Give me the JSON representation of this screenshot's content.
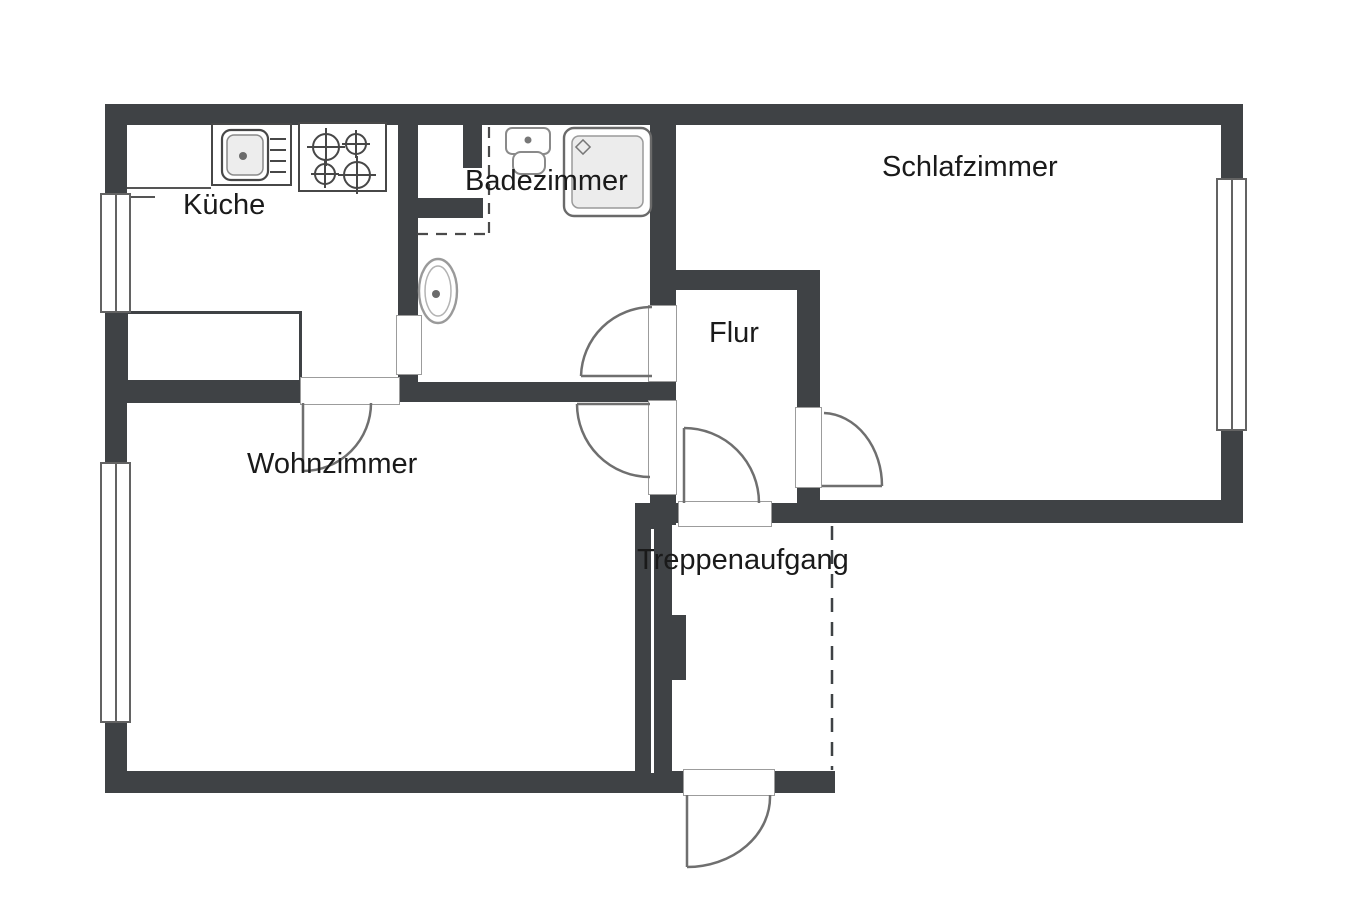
{
  "plan": {
    "rooms": [
      {
        "id": "kueche",
        "label": "Küche"
      },
      {
        "id": "badezimmer",
        "label": "Badezimmer"
      },
      {
        "id": "schlafzimmer",
        "label": "Schlafzimmer"
      },
      {
        "id": "flur",
        "label": "Flur"
      },
      {
        "id": "wohnzimmer",
        "label": "Wohnzimmer"
      },
      {
        "id": "treppenaufgang",
        "label": "Treppenaufgang"
      }
    ],
    "fixtures": [
      "kitchen-sink-unit",
      "stove-four-burners",
      "kitchen-counter",
      "sideboard",
      "washbasin",
      "shower",
      "toilet"
    ],
    "symbols": {
      "windows": 3,
      "door-openings": 7,
      "stairwell_edge": "dashed-line",
      "bath_niche_edge": "dashed-line"
    },
    "colors": {
      "wall": "#3f4245",
      "background": "#ffffff",
      "fixture_outline": "#474747",
      "light_outline": "#9a9a9a",
      "arc": "#6f6f6f",
      "text": "#1a1a1a"
    }
  }
}
